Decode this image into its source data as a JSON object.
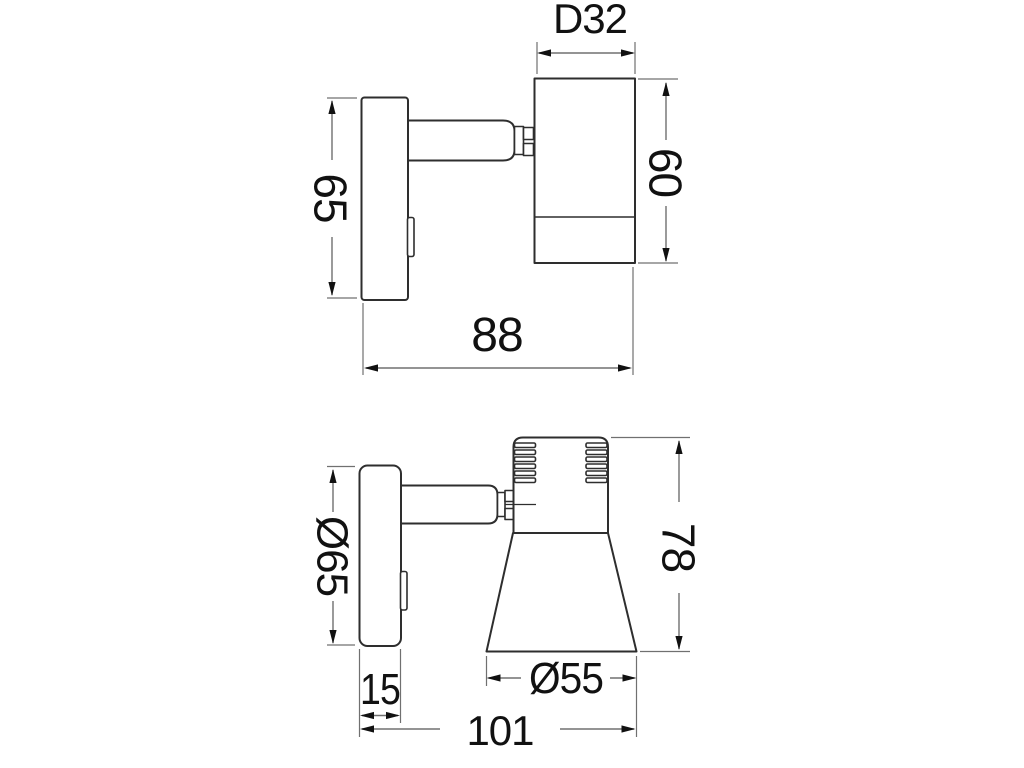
{
  "colors": {
    "background": "#ffffff",
    "object_line": "#2e2e2e",
    "dim_line": "#707070",
    "text": "#111111"
  },
  "views": {
    "upper": {
      "dims": {
        "head_diameter": "D32",
        "head_length": "60",
        "plate_height": "65",
        "overall_depth": "88"
      }
    },
    "lower": {
      "dims": {
        "plate_diameter": "Ø65",
        "overall_height": "78",
        "plate_thickness": "15",
        "shade_diameter": "Ø55",
        "overall_width": "101"
      }
    }
  }
}
